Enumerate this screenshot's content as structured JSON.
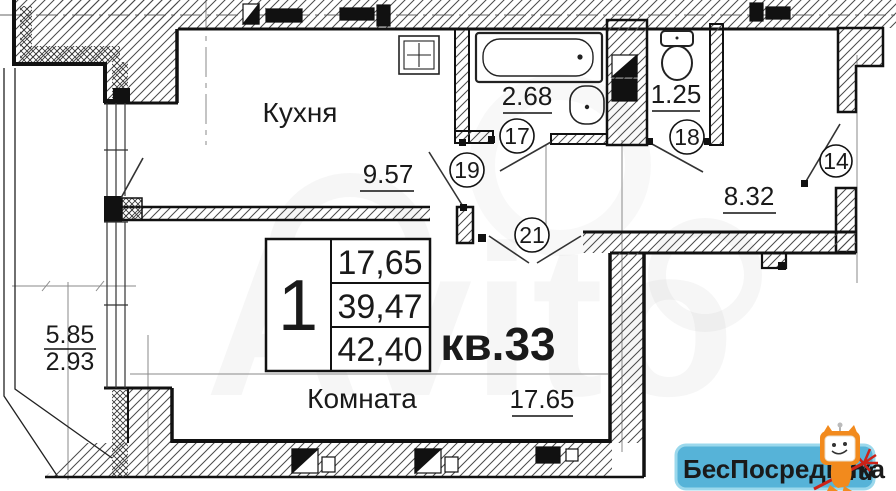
{
  "plan": {
    "apartment_label": "кв.33",
    "kitchen": {
      "label": "Кухня",
      "dim": "9.57",
      "door_tag": "19"
    },
    "bathroom": {
      "dim": "2.68",
      "door_tag": "17"
    },
    "wc": {
      "dim": "1.25",
      "door_tag": "18"
    },
    "hall": {
      "dim": "8.32",
      "door_tag": "14"
    },
    "room": {
      "label": "Комната",
      "dim": "17.65",
      "door_tag": "21"
    },
    "balcony": {
      "dim_length": "5.85",
      "dim_width": "2.93"
    },
    "summary": {
      "rooms_count": "1",
      "living": "17,65",
      "subtotal": "39,47",
      "total": "42,40"
    },
    "icons": {
      "bathtub": "bathtub-icon",
      "bath_sink": "sink-icon",
      "toilet": "toilet-icon",
      "kitchen_sink": "kitchen-sink-icon",
      "mascot": "mascot-tv-cat-icon"
    }
  },
  "watermarks": {
    "ghost_text": "Avito",
    "badge": {
      "brand": "БесПосредника",
      "tld": ".ru"
    }
  },
  "colors": {
    "line": "#111111",
    "hatch": "#4a4a4a",
    "axis": "#8a8a8a",
    "badge_bg": "#56b3d8",
    "badge_border": "#9bd8ec",
    "badge_text": "#175079",
    "badge_tld": "#b5271c",
    "mascot_orange": "#f28a1d"
  }
}
